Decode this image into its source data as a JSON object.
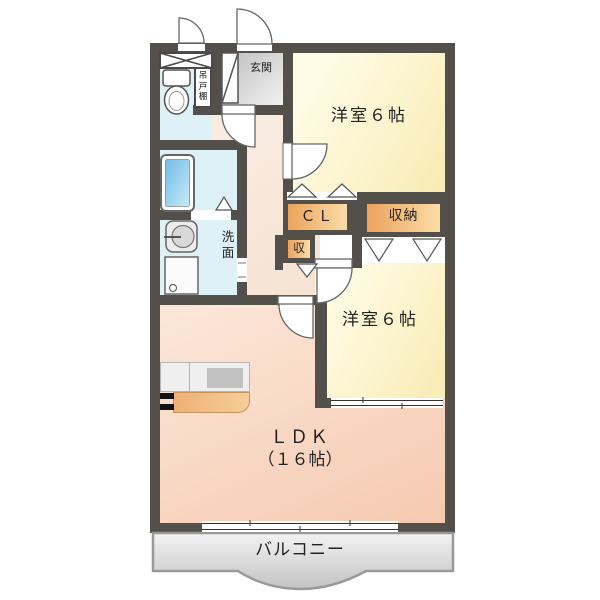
{
  "plan": {
    "rooms": {
      "bedroom_top": {
        "label": "洋室６帖"
      },
      "bedroom_right": {
        "label": "洋室６帖"
      },
      "ldk": {
        "label": "ＬＤＫ",
        "size_label": "（１６帖）"
      },
      "balcony": {
        "label": "バルコニー"
      },
      "entrance": {
        "label": "玄関"
      },
      "washroom": {
        "label": "洗面"
      },
      "closet": {
        "label": "ＣＬ"
      },
      "storage": {
        "label": "収納"
      },
      "storage_small": {
        "label": "収"
      },
      "hanging_cupboard": {
        "label": "吊戸棚"
      }
    },
    "colors": {
      "wall": "#534F4B",
      "bedroom_floor": "#FAF0C0",
      "ldk_floor": "#F8D5C0",
      "hallway_floor": "#F8EADD",
      "wet_area_floor": "#DDF1F7",
      "storage_fill": "#F3BC80",
      "entrance_fill": "#D8D8D8",
      "balcony_fill": "#DCDCDC",
      "bathtub_fill": "#7FC4E8"
    }
  }
}
